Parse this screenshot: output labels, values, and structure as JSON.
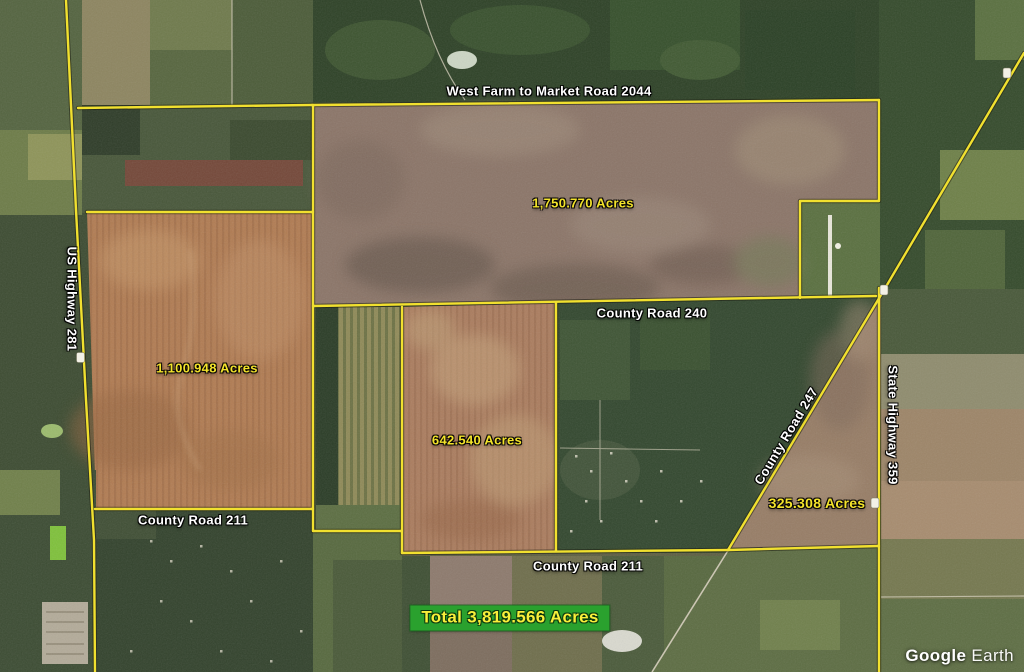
{
  "map": {
    "road_labels": [
      {
        "id": "fm2044",
        "text": "West Farm to Market Road 2044"
      },
      {
        "id": "us281",
        "text": "US Highway 281"
      },
      {
        "id": "cr240",
        "text": "County Road 240"
      },
      {
        "id": "cr247",
        "text": "County Road 247"
      },
      {
        "id": "sh359",
        "text": "State Highway 359"
      },
      {
        "id": "cr211_west",
        "text": "County Road 211"
      },
      {
        "id": "cr211_east",
        "text": "County Road 211"
      }
    ],
    "parcels": [
      {
        "acreage_label": "1,750.770 Acres",
        "acres": 1750.77
      },
      {
        "acreage_label": "1,100.948 Acres",
        "acres": 1100.948
      },
      {
        "acreage_label": "642.540 Acres",
        "acres": 642.54
      },
      {
        "acreage_label": "325.308 Acres",
        "acres": 325.308
      }
    ],
    "total_label": "Total 3,819.566 Acres",
    "colors": {
      "boundary_yellow": "#f1e02f",
      "parcel_label_yellow": "#f3e32b",
      "road_label_white": "#ffffff",
      "total_box_green": "#2aa12e",
      "total_text_yellow": "#f8ef3a"
    }
  },
  "watermark": {
    "primary": "Google",
    "secondary": "Earth"
  }
}
